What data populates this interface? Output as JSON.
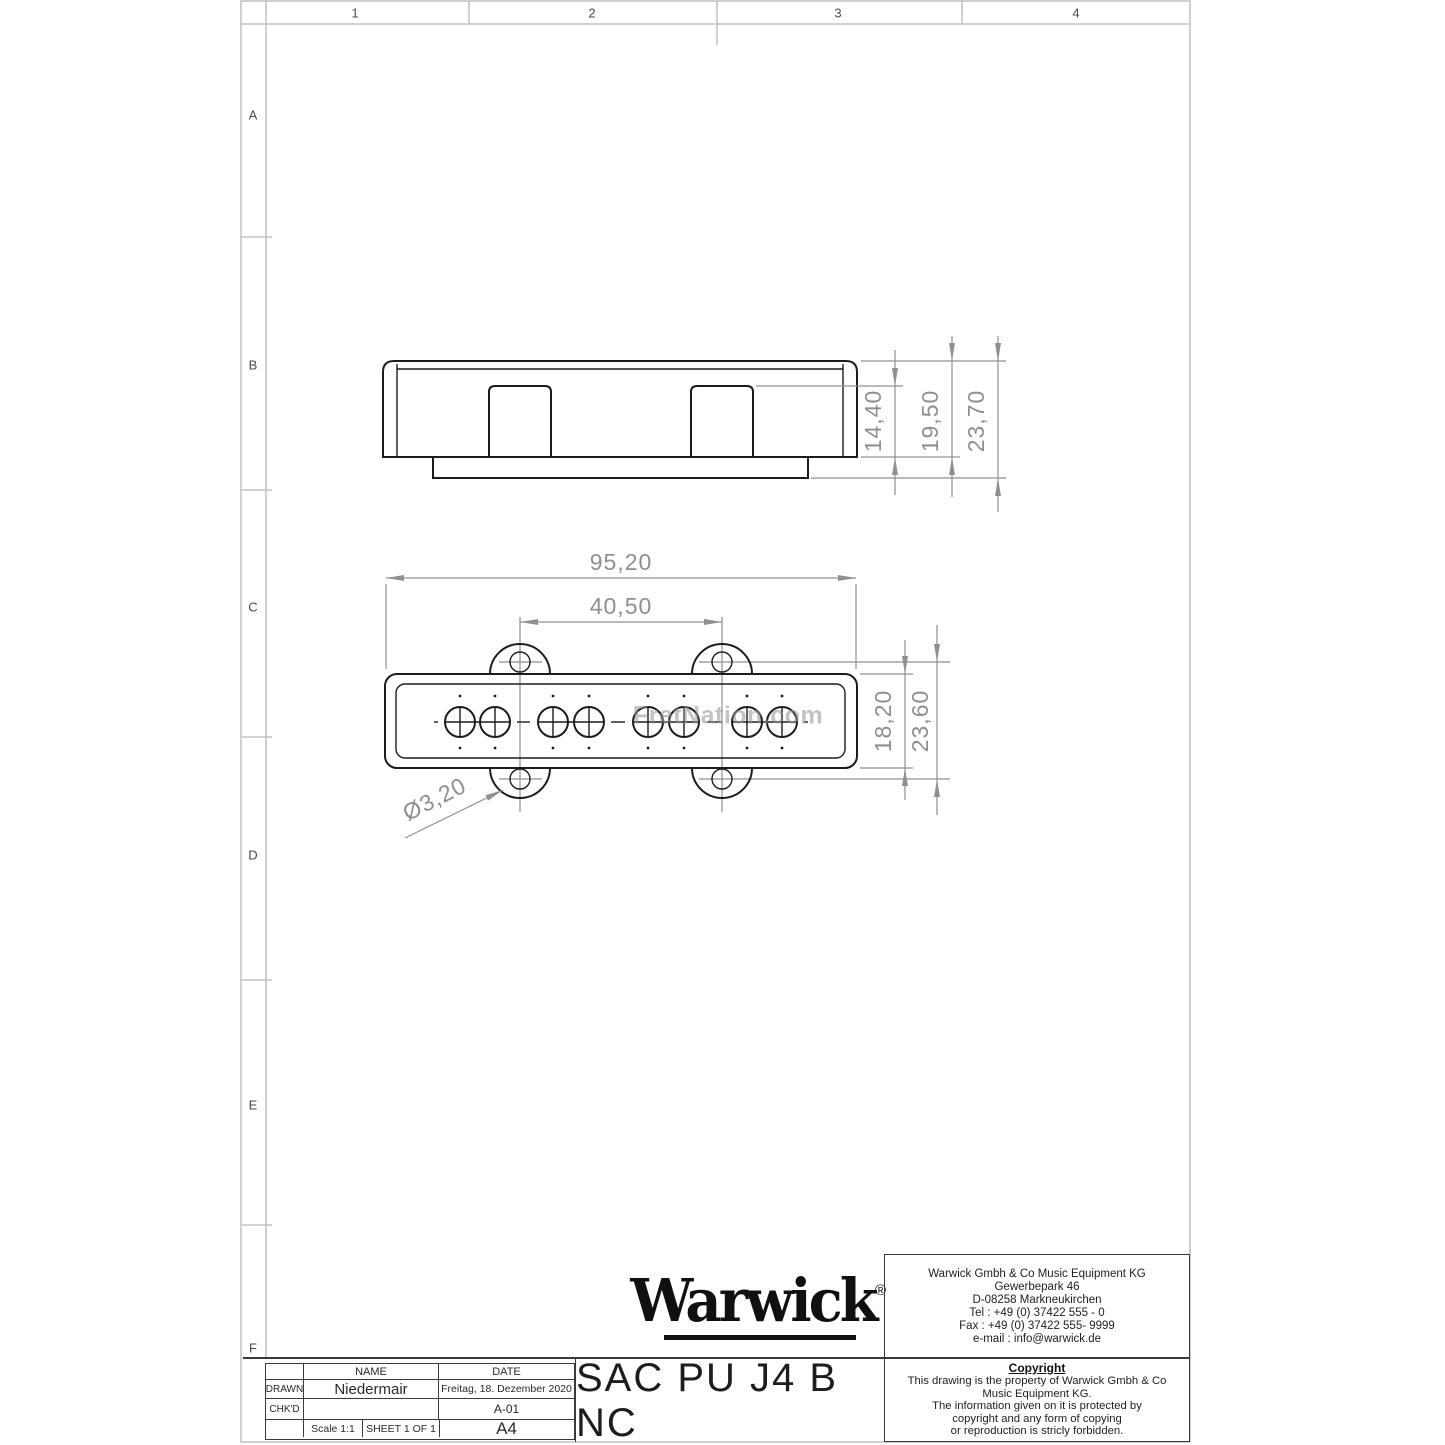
{
  "sheet": {
    "zones": {
      "columns": [
        "1",
        "2",
        "3",
        "4"
      ],
      "rows": [
        "A",
        "B",
        "C",
        "D",
        "E",
        "F"
      ]
    },
    "watermark": "FretNation.com"
  },
  "dimensions": {
    "side_view": {
      "inner_height": "14,40",
      "body_height": "19,50",
      "total_height": "23,70"
    },
    "top_view": {
      "overall_width": "95,20",
      "hole_spacing": "40,50",
      "body_width": "18,20",
      "ear_hole_span": "23,60",
      "hole_diameter": "Ø3,20"
    }
  },
  "title_block": {
    "logo_text": "Warwick",
    "logo_reg": "®",
    "name_header": "NAME",
    "date_header": "DATE",
    "drawn_label": "DRAWN",
    "drawn_name": "Niedermair",
    "drawn_date": "Freitag, 18. Dezember 2020",
    "chkd_label": "CHK'D",
    "chkd_value": "",
    "revision": "A-01",
    "scale": "Scale 1:1",
    "sheet": "SHEET 1 OF 1",
    "paper_size": "A4",
    "drawing_title": "SAC PU J4 B NC"
  },
  "company": {
    "lines": [
      "Warwick Gmbh & Co Music Equipment KG",
      "Gewerbepark 46",
      "D-08258 Markneukirchen",
      "Tel : +49 (0) 37422 555 - 0",
      "Fax : +49 (0) 37422 555- 9999",
      "e-mail : info@warwick.de"
    ]
  },
  "copyright": {
    "header": "Copyright",
    "lines": [
      "This drawing is the property of Warwick Gmbh & Co",
      "Music Equipment KG.",
      "The information given on it is protected by",
      "copyright and any form of copying",
      "or reproduction is stricly forbidden."
    ]
  },
  "colors": {
    "part_line": "#1c1c1c",
    "dimension": "#909090",
    "frame": "#c4c4c4",
    "text": "#222222"
  }
}
